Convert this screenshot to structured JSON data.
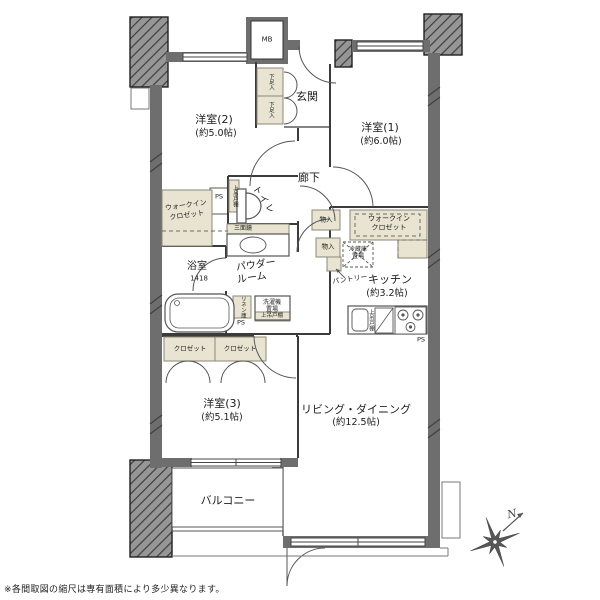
{
  "meta": {
    "type": "floorplan",
    "footnote": "※各間取図の縮尺は専有面積により多少異なります。"
  },
  "colors": {
    "wall": "#6e6e6e",
    "column_hatch_base": "#969696",
    "column_hatch_line": "#3e3e3e",
    "storage_beige": "#e8e4d1",
    "line": "#3b3b3b",
    "background": "#ffffff"
  },
  "rooms": {
    "yo2": {
      "name": "洋室(2)",
      "size": "(約5.0帖)"
    },
    "yo1": {
      "name": "洋室(1)",
      "size": "(約6.0帖)"
    },
    "yo3": {
      "name": "洋室(3)",
      "size": "(約5.1帖)"
    },
    "ld": {
      "name": "リビング・ダイニング",
      "size": "(約12.5帖)"
    },
    "kitchen": {
      "name": "キッチン",
      "size": "(約3.2帖)"
    },
    "genkan": "玄関",
    "rouka": "廊下",
    "toilet": "トイレ",
    "bath": {
      "name": "浴室",
      "size": "1418"
    },
    "powder": {
      "line1": "パウダー",
      "line2": "ルーム"
    },
    "balcony": "バルコニー"
  },
  "storage": {
    "wic": {
      "line1": "ウォークイン",
      "line2": "クロゼット"
    },
    "closet": "クロゼット",
    "shoe": "下足入",
    "monoire": "物入",
    "pantry": "パントリー",
    "linen": "リネン庫",
    "fridge": {
      "line1": "冷蔵庫",
      "line2": "置場"
    },
    "washer": {
      "line1": "洗濯機",
      "line2": "置場"
    },
    "shelf": "上吊戸棚",
    "mirror": "三面鏡"
  },
  "labels": {
    "mb": "MB",
    "ps": "PS",
    "north": "N"
  }
}
